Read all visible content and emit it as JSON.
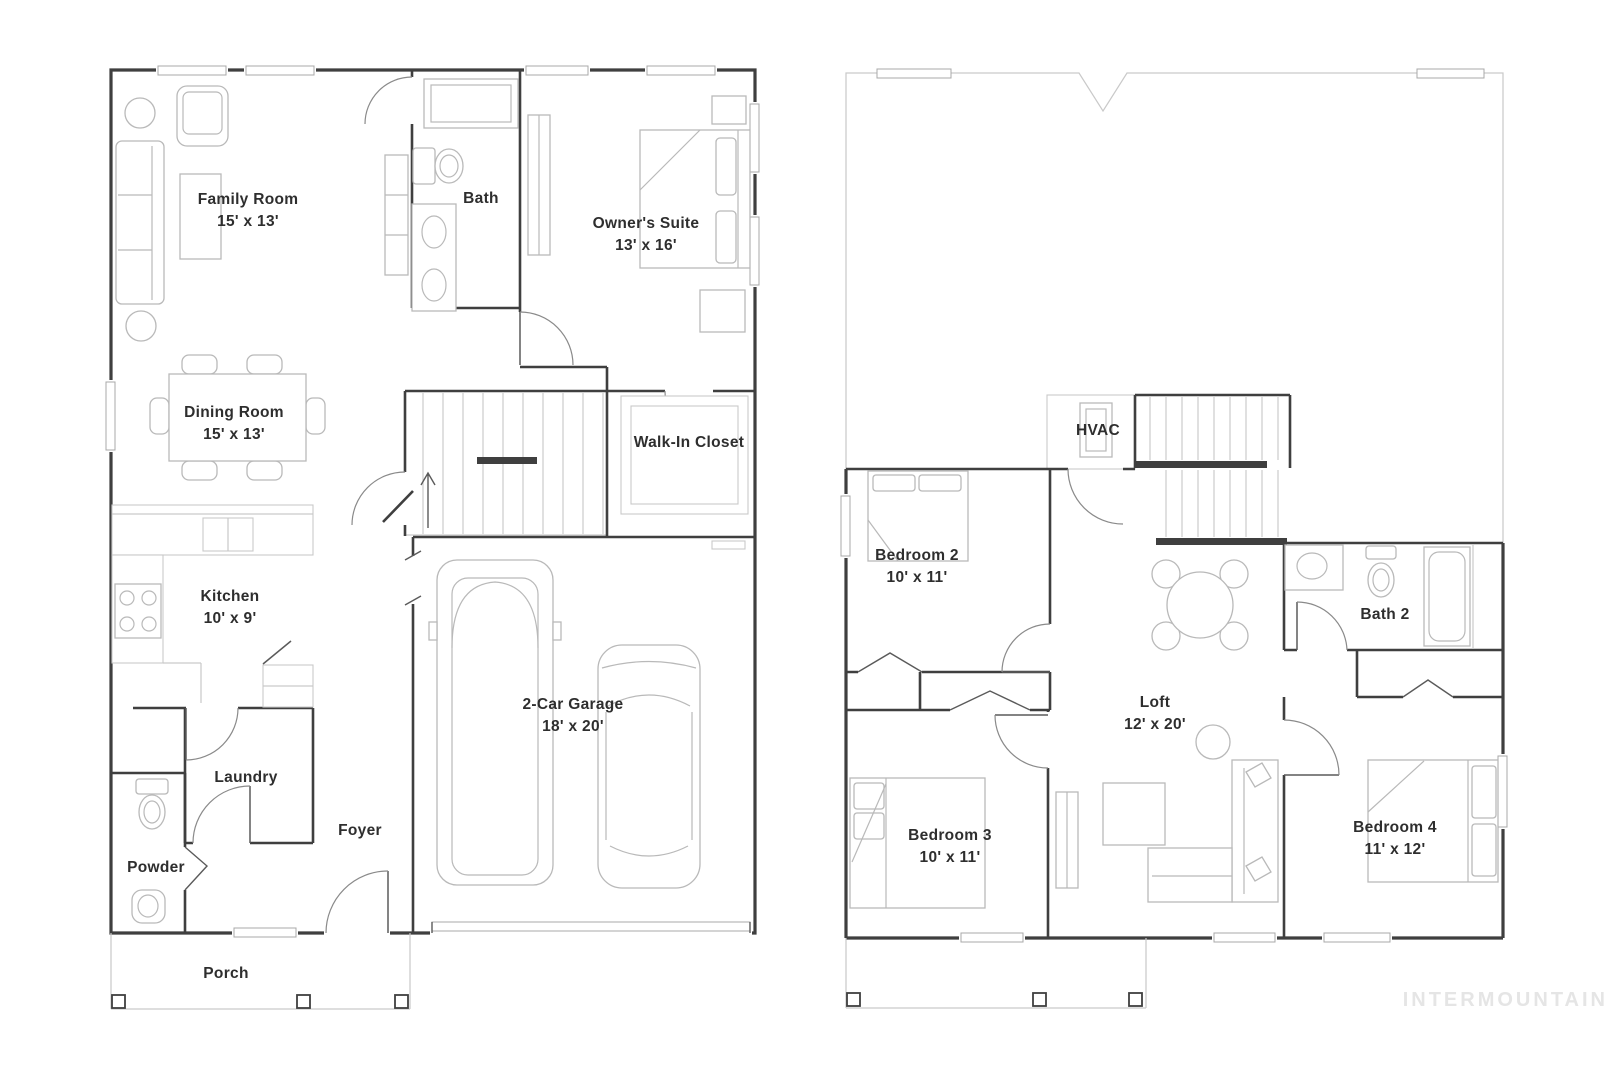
{
  "watermark": "INTERMOUNTAIN",
  "floors": [
    {
      "id": "first-floor",
      "rooms": [
        {
          "name": "Family Room",
          "dims": "15' x 13'"
        },
        {
          "name": "Bath",
          "dims": ""
        },
        {
          "name": "Owner's Suite",
          "dims": "13' x 16'"
        },
        {
          "name": "Dining Room",
          "dims": "15' x 13'"
        },
        {
          "name": "Walk-In Closet",
          "dims": ""
        },
        {
          "name": "Kitchen",
          "dims": "10' x 9'"
        },
        {
          "name": "2-Car Garage",
          "dims": "18' x 20'"
        },
        {
          "name": "Laundry",
          "dims": ""
        },
        {
          "name": "Foyer",
          "dims": ""
        },
        {
          "name": "Powder",
          "dims": ""
        },
        {
          "name": "Porch",
          "dims": ""
        }
      ]
    },
    {
      "id": "second-floor",
      "rooms": [
        {
          "name": "HVAC",
          "dims": ""
        },
        {
          "name": "Bedroom 2",
          "dims": "10' x 11'"
        },
        {
          "name": "Bath 2",
          "dims": ""
        },
        {
          "name": "Loft",
          "dims": "12' x 20'"
        },
        {
          "name": "Bedroom 3",
          "dims": "10' x 11'"
        },
        {
          "name": "Bedroom 4",
          "dims": "11' x 12'"
        }
      ]
    }
  ],
  "colors": {
    "wall": "#3f3f3f",
    "light_line": "#c9c9c9",
    "furniture": "#b9b9b9",
    "door_arc": "#8a8a8a",
    "text": "#2e2e2e",
    "watermark": "#e5e5e5",
    "background": "#ffffff"
  }
}
